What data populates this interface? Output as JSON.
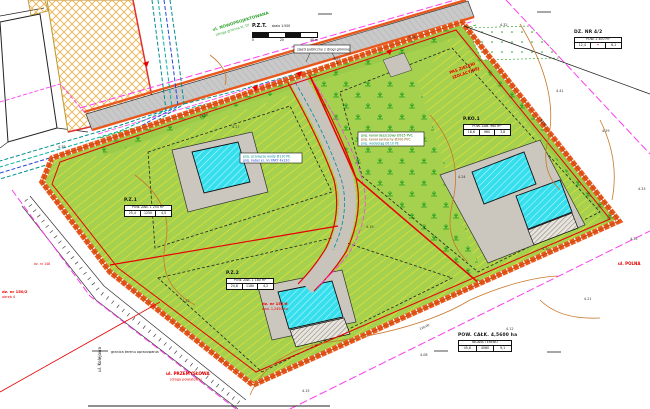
{
  "drawing": {
    "streets": {
      "new_road_1": "ul. NOWOPROJEKTOWANA",
      "new_road_2": "(droga gminna kl. D)",
      "south": "ul. PRZEMYSŁOWA",
      "south_2": "(droga powiatowa)",
      "east": "ul. POLNA",
      "west_vertical": "ul. Kolejowa"
    },
    "parcels": {
      "p1": "dz. nr 150/2",
      "p1b": "obręb 4",
      "p2": "dz. nr 152/6",
      "p2b": "pow. 1,2450 ha",
      "p3": "dz. nr 148"
    },
    "green_belt_1": "PAS ZIELENI",
    "green_belt_2": "IZOLACYJNEJ",
    "callout_road": "zjazd publiczny z drogi gminnej",
    "utility_note_1": "proj. przyłącze wody Ø110 PE",
    "utility_note_2": "proj. kabel el. nn YAKY 4x120",
    "utility_note_3": "proj. kanał deszczowy Ø315 PVC",
    "utility_note_4": "proj. kanał sanitarny Ø200 PVC",
    "utility_note_5": "proj. wodociąg Ø110 PE",
    "legend_boundary": "granica terenu opracowania",
    "scalebar": {
      "title": "P.Z.T.",
      "scale": "skala 1:500",
      "m0": "0",
      "m20": "20",
      "m40": "40 m"
    }
  },
  "tables": {
    "t1": {
      "caption": "P.Z.1",
      "header": "POW. ZAB. 1 254 m²",
      "c1": "25,4",
      "c2": "1250",
      "c3": "4,5"
    },
    "t2": {
      "caption": "P.Z.2",
      "header": "POW. ZAB. 1 180 m²",
      "c1": "24,8",
      "c2": "1180",
      "c3": "4,2"
    },
    "t3": {
      "caption": "P.KO.1",
      "header": "POW. ZAB. 960 m²",
      "c1": "18,6",
      "c2": "960",
      "c3": "3,8"
    },
    "t4": {
      "caption": "DZ. NR 4/2",
      "header": "POW. 2 400 m²",
      "c1": "12,4",
      "c2": "•",
      "c3": "6,1"
    },
    "t5": {
      "caption": "POW. CAŁK. 4,5600 ha",
      "header": "BILANS TERENU",
      "c1": "45,6",
      "c2": "4560",
      "c3": "9,1"
    }
  },
  "elevations": [
    "4.25",
    "4.18",
    "4.32",
    "4.41",
    "4.29",
    "4.35",
    "4.21",
    "4.12",
    "4.08",
    "4.15",
    "4.22",
    "4.31",
    "4.27",
    "4.19",
    "4.24",
    "4.30",
    "4.38",
    "4.33"
  ],
  "dims": [
    "62,00",
    "98,50",
    "120,00"
  ],
  "colors": {
    "boundary_orange": "#E8581C",
    "plot_green": "#A5D14E",
    "building_cyan": "#35DFEE",
    "magenta": "#FF3DF0",
    "red": "#E80000",
    "teal": "#008F8F",
    "contour_brown": "#C8782D",
    "tree_green": "#1C9C1C",
    "hatch_yellow": "#F2E42E",
    "existing_hatch": "#EFB04C"
  }
}
